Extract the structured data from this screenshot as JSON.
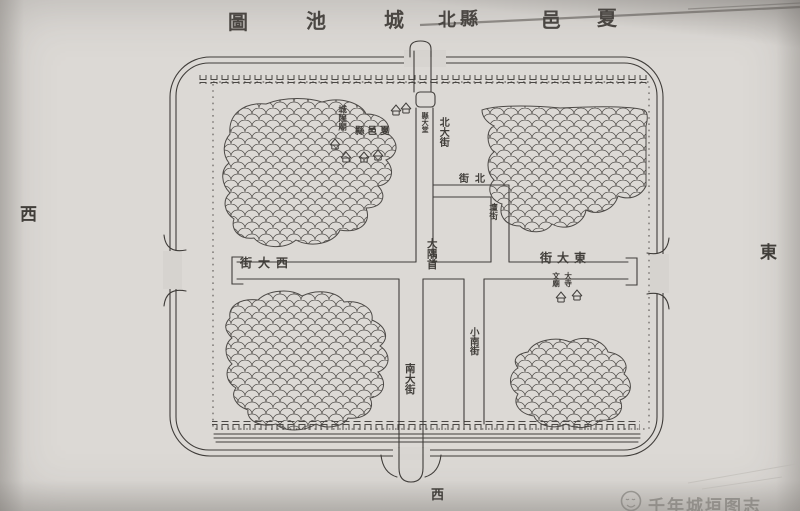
{
  "title": {
    "full": "夏邑縣北城池圖",
    "chars": [
      "圖",
      "池",
      "城",
      "北",
      "縣",
      "邑",
      "夏"
    ]
  },
  "compass": {
    "west": "西",
    "east": "東",
    "bottom": "西"
  },
  "streets": {
    "north_main": "北大街",
    "central_crossroads": "大隅首",
    "south_main": "南大街",
    "small_south": "小南街",
    "north_street_display": "街北",
    "altar_street": "壇街",
    "west_main_display": "街大西",
    "east_main_display": "街大東"
  },
  "places": {
    "city_god_temple": "城隍廟",
    "county_seat_display": "縣邑夏",
    "county_hall": "縣大堂",
    "temple_left": "文廟",
    "temple_right": "大寺"
  },
  "watermark": {
    "text": "千年城垣图志"
  },
  "colors": {
    "paper": "#d7d4d0",
    "ink": "#403d3a",
    "watermark": "#9a9792"
  }
}
